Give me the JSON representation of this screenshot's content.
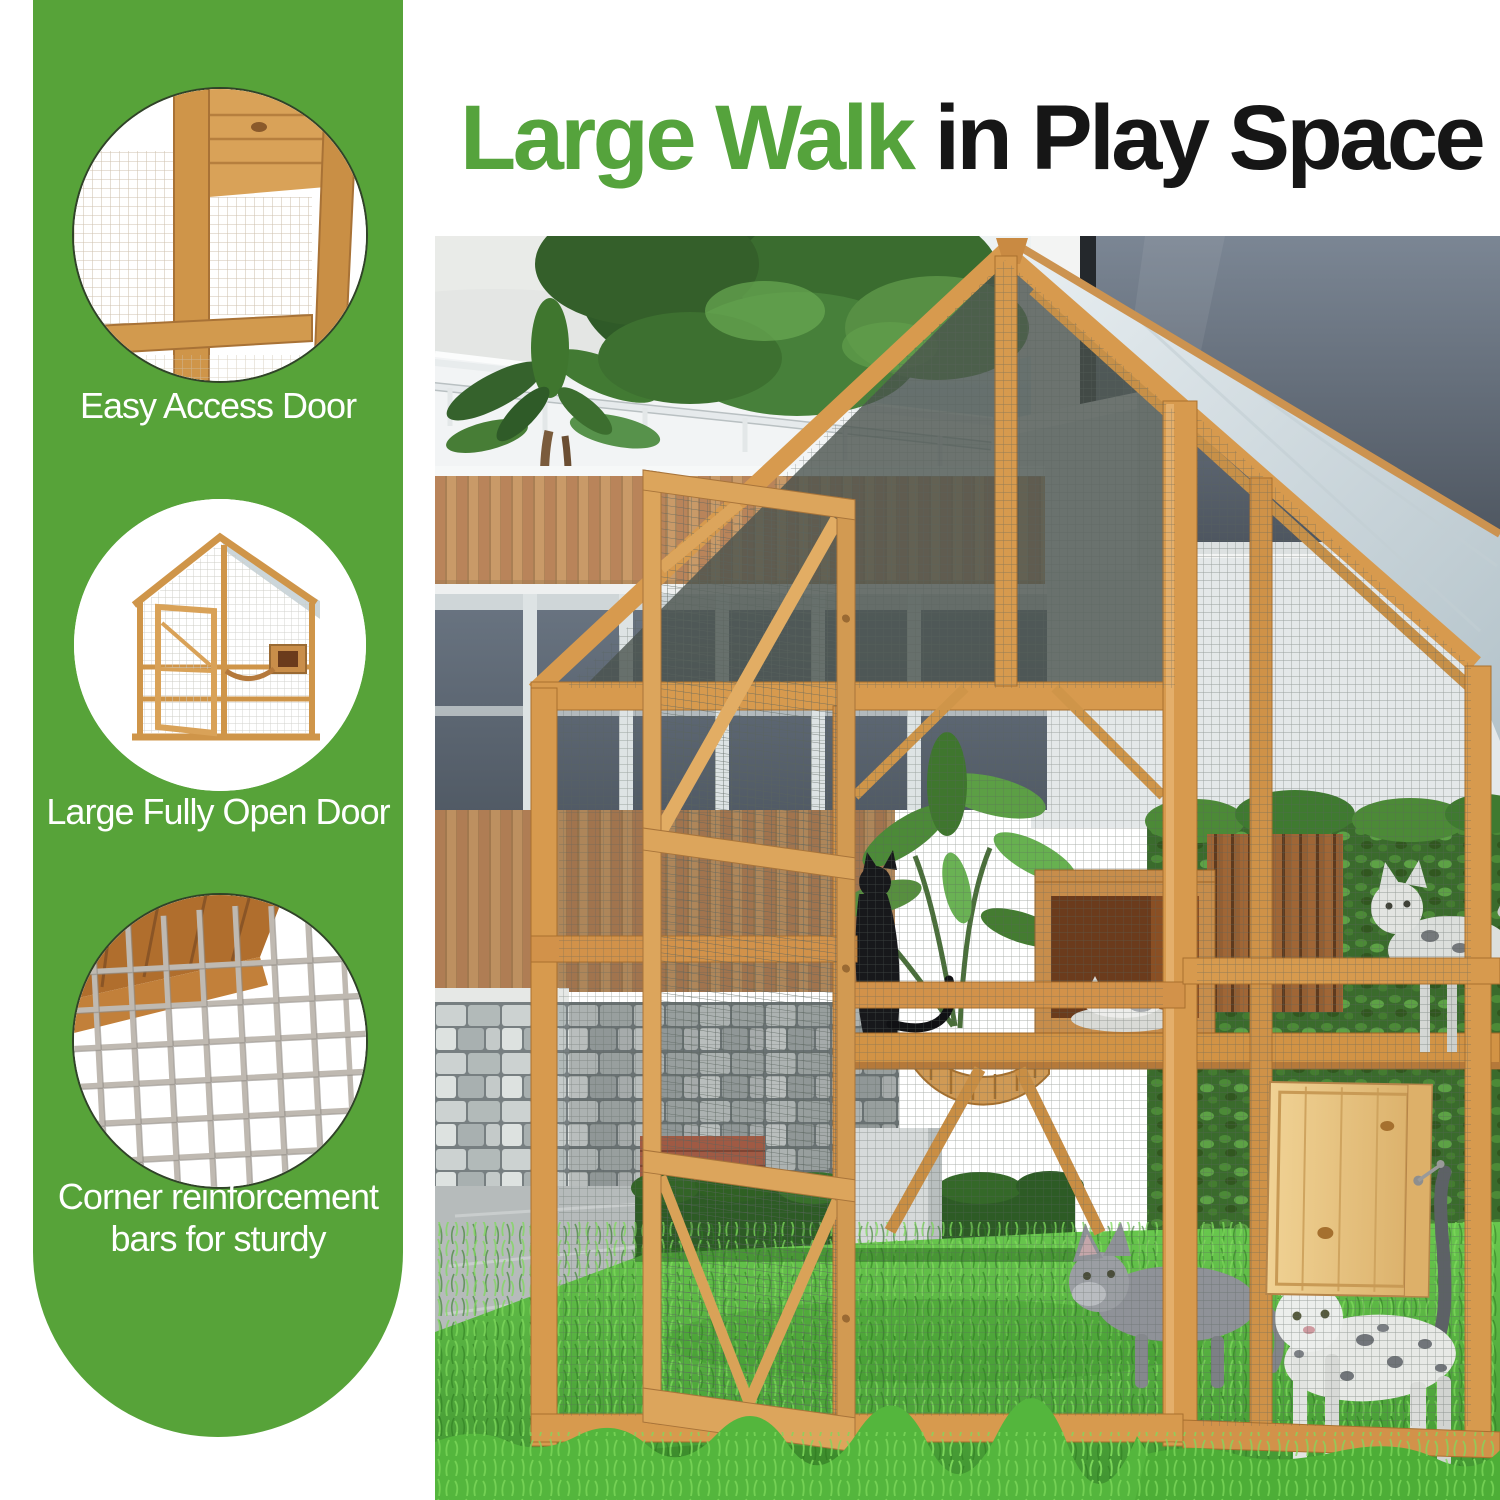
{
  "title": {
    "highlight": "Large Walk",
    "rest": " in Play Space"
  },
  "colors": {
    "brand_green": "#57a339",
    "title_green": "#55a33c",
    "title_black": "#161616",
    "label_white": "#ffffff"
  },
  "sidebar": {
    "features": [
      {
        "label": "Easy Access Door",
        "image": "wooden-door-frame-closeup"
      },
      {
        "label": "Large Fully Open Door",
        "image": "catio-with-fully-open-door"
      },
      {
        "label": "Corner reinforcement bars for sturdy",
        "image": "wire-mesh-corner-closeup"
      }
    ]
  },
  "photo": {
    "image": "catio-backyard-scene-with-cats"
  }
}
